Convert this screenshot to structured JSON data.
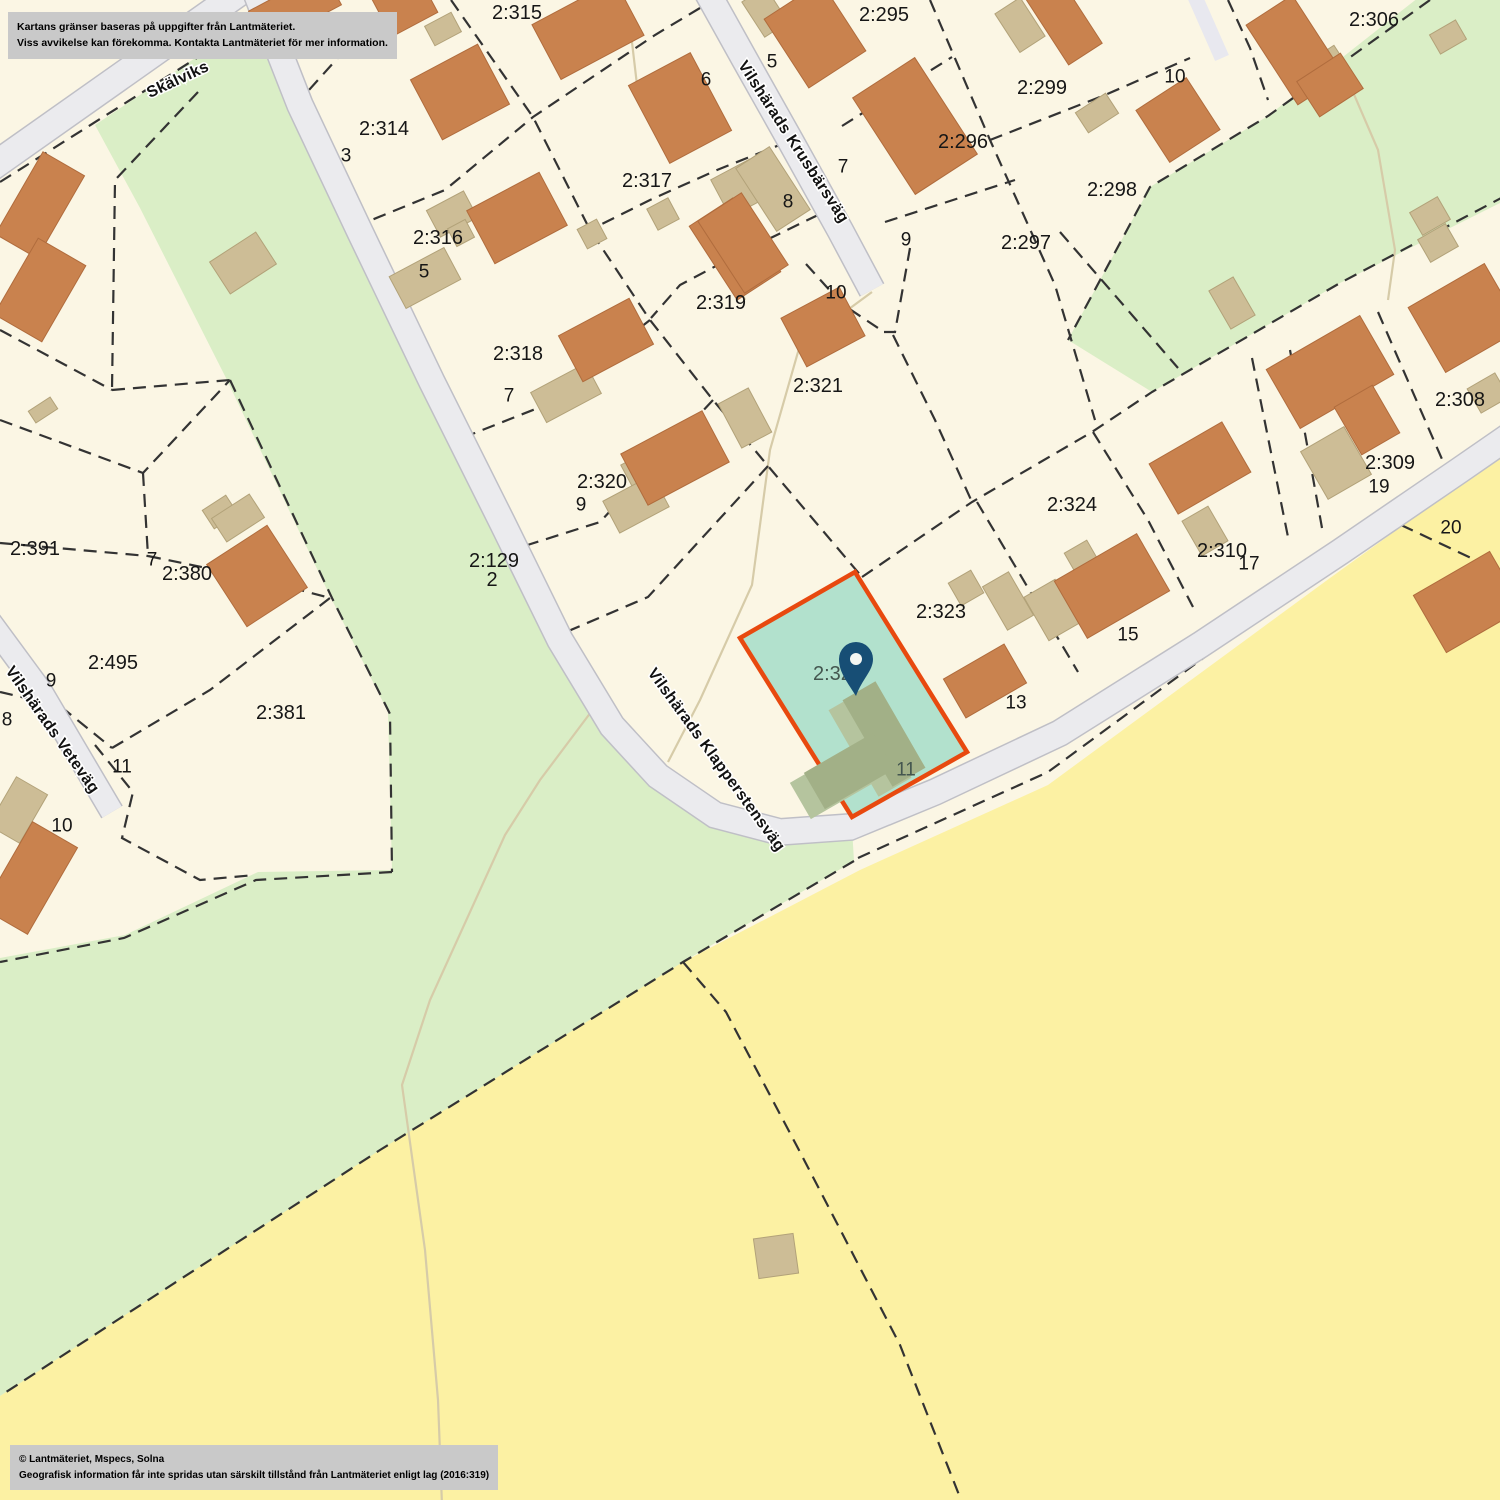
{
  "notice": {
    "line1": "Kartans gränser baseras på uppgifter från Lantmäteriet.",
    "line2": "Viss avvikelse kan förekomma. Kontakta Lantmäteriet för mer information."
  },
  "copyright": {
    "line1": "© Lantmäteriet, Mspecs, Solna",
    "line2": "Geografisk information får inte spridas utan särskilt tillstånd från Lantmäteriet enligt lag (2016:319)"
  },
  "highlight": {
    "parcel_label": "2:322",
    "house_number": "11",
    "parcel_label_pos": [
      838,
      674
    ],
    "house_number_pos": [
      906,
      770
    ]
  },
  "streets": [
    {
      "name": "Skälviks",
      "x": 178,
      "y": 80,
      "rot": -25
    },
    {
      "name": "Vilshärads Krusbärsväg",
      "x": 793,
      "y": 142,
      "rot": 57
    },
    {
      "name": "Vilshärads Klapperstensväg",
      "x": 716,
      "y": 760,
      "rot": 54
    },
    {
      "name": "Vilshärads Veteväg",
      "x": 52,
      "y": 730,
      "rot": 55
    }
  ],
  "parcel_labels": [
    {
      "t": "2:312",
      "x": 341,
      "y": 43
    },
    {
      "t": "2:315",
      "x": 517,
      "y": 13
    },
    {
      "t": "2:314",
      "x": 384,
      "y": 129
    },
    {
      "t": "2:316",
      "x": 438,
      "y": 238
    },
    {
      "t": "2:317",
      "x": 647,
      "y": 181
    },
    {
      "t": "2:318",
      "x": 518,
      "y": 354
    },
    {
      "t": "2:319",
      "x": 721,
      "y": 303
    },
    {
      "t": "2:320",
      "x": 602,
      "y": 482
    },
    {
      "t": "2:321",
      "x": 818,
      "y": 386
    },
    {
      "t": "2:295",
      "x": 884,
      "y": 15
    },
    {
      "t": "2:296",
      "x": 963,
      "y": 142
    },
    {
      "t": "2:299",
      "x": 1042,
      "y": 88
    },
    {
      "t": "2:297",
      "x": 1026,
      "y": 243
    },
    {
      "t": "2:298",
      "x": 1112,
      "y": 190
    },
    {
      "t": "2:306",
      "x": 1374,
      "y": 20
    },
    {
      "t": "2:308",
      "x": 1460,
      "y": 400
    },
    {
      "t": "2:309",
      "x": 1390,
      "y": 463
    },
    {
      "t": "2:310",
      "x": 1222,
      "y": 551
    },
    {
      "t": "2:323",
      "x": 941,
      "y": 612
    },
    {
      "t": "2:324",
      "x": 1072,
      "y": 505
    },
    {
      "t": "2:391",
      "x": 35,
      "y": 549
    },
    {
      "t": "2:380",
      "x": 187,
      "y": 574
    },
    {
      "t": "2:495",
      "x": 113,
      "y": 663
    },
    {
      "t": "2:381",
      "x": 281,
      "y": 713
    },
    {
      "t": "2:129",
      "x": 494,
      "y": 561
    },
    {
      "t": "2",
      "x": 492,
      "y": 580
    }
  ],
  "house_numbers": [
    {
      "t": "3",
      "x": 346,
      "y": 156
    },
    {
      "t": "5",
      "x": 424,
      "y": 272
    },
    {
      "t": "7",
      "x": 509,
      "y": 396
    },
    {
      "t": "9",
      "x": 581,
      "y": 505
    },
    {
      "t": "5",
      "x": 772,
      "y": 62
    },
    {
      "t": "6",
      "x": 706,
      "y": 80
    },
    {
      "t": "7",
      "x": 843,
      "y": 167
    },
    {
      "t": "8",
      "x": 788,
      "y": 202
    },
    {
      "t": "9",
      "x": 906,
      "y": 240
    },
    {
      "t": "10",
      "x": 836,
      "y": 293
    },
    {
      "t": "10",
      "x": 1175,
      "y": 77
    },
    {
      "t": "19",
      "x": 1379,
      "y": 487
    },
    {
      "t": "17",
      "x": 1249,
      "y": 564
    },
    {
      "t": "20",
      "x": 1451,
      "y": 528
    },
    {
      "t": "13",
      "x": 1016,
      "y": 703
    },
    {
      "t": "15",
      "x": 1128,
      "y": 635
    },
    {
      "t": "7",
      "x": 152,
      "y": 560
    },
    {
      "t": "9",
      "x": 51,
      "y": 681
    },
    {
      "t": "8",
      "x": 7,
      "y": 720
    },
    {
      "t": "11",
      "x": 122,
      "y": 767
    },
    {
      "t": "10",
      "x": 62,
      "y": 826
    }
  ],
  "colors": {
    "cream": "#fbf6e4",
    "green": "#daeec6",
    "yellow": "#fcf1a3",
    "road": "#ebebee",
    "road_casing": "#bfbfc6",
    "driveway": "#e8e8ef",
    "boundary": "#333333",
    "trail": "#d6cba8",
    "building_orange": "#c9824e",
    "building_orange_edge": "#b06c3d",
    "building_tan": "#cdbd96",
    "building_tan_edge": "#b2a279",
    "highlight_fill": "#b2e1cd",
    "highlight_border": "#e8490f",
    "building_olive": "#a2b087",
    "building_olive_light": "#b5c49e",
    "pin": "#174e75",
    "pin_hole": "#f4f6f2",
    "label": "#161616",
    "highlight_label": "#44564f",
    "notice_bg": "#c9c9c9"
  }
}
